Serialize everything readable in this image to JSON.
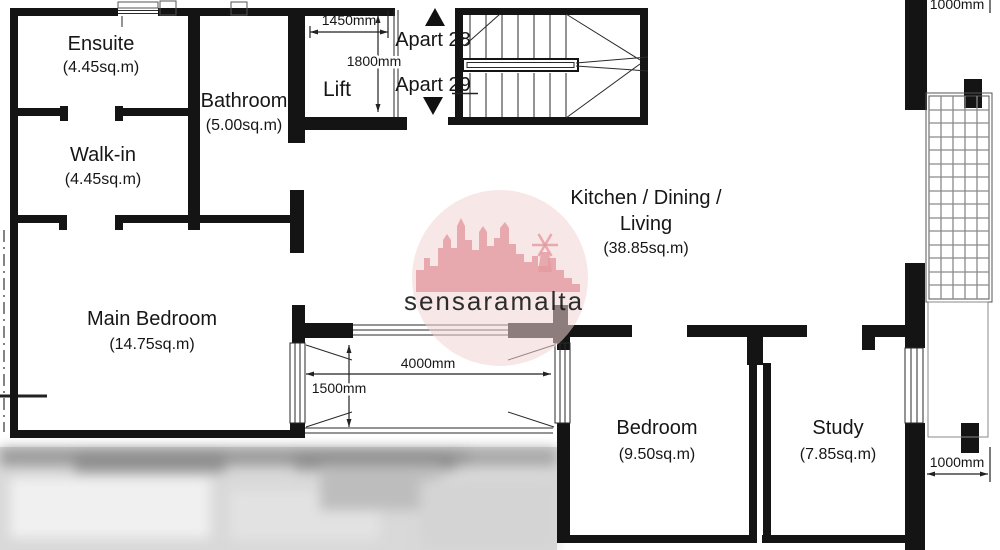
{
  "plan": {
    "rooms": {
      "ensuite": {
        "name": "Ensuite",
        "area": "(4.45sq.m)"
      },
      "bathroom": {
        "name": "Bathroom",
        "area": "(5.00sq.m)"
      },
      "walk_in": {
        "name": "Walk-in",
        "area": "(4.45sq.m)"
      },
      "lift": {
        "name": "Lift"
      },
      "kitchen": {
        "name_line1": "Kitchen / Dining /",
        "name_line2": "Living",
        "area": "(38.85sq.m)"
      },
      "main_bedroom": {
        "name": "Main Bedroom",
        "area": "(14.75sq.m)"
      },
      "bedroom": {
        "name": "Bedroom",
        "area": "(9.50sq.m)"
      },
      "study": {
        "name": "Study",
        "area": "(7.85sq.m)"
      }
    },
    "apartments": {
      "up_label": "Apart 28",
      "down_label": "Apart 29"
    },
    "dimensions": {
      "lift_width": "1450mm",
      "lift_depth": "1800mm",
      "sliding_door_width": "4000mm",
      "terrace_depth": "1500mm",
      "right_walkway_width": "1000mm",
      "top_right_width": "1000mm"
    },
    "watermark": {
      "text": "sensaramalta"
    },
    "colors": {
      "wall": "#141414",
      "line": "#2a2a2a",
      "watermark_circle": "#f2d3d3",
      "watermark_silhouette": "#e29aa0",
      "watermark_text": "#f3cfcf"
    }
  }
}
